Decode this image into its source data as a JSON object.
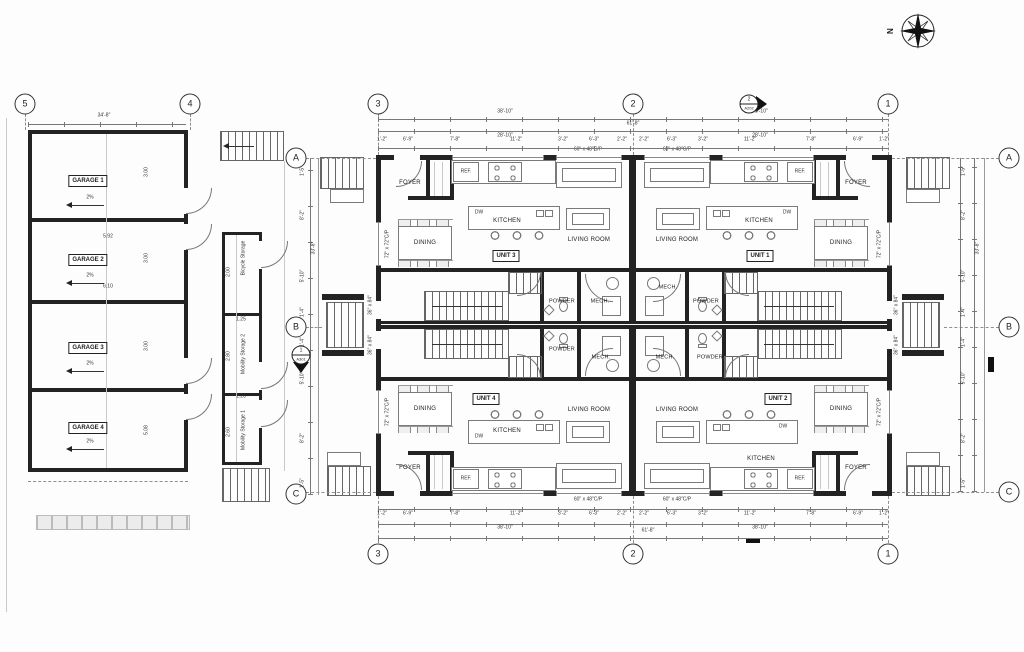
{
  "compass": {
    "north": "N"
  },
  "grid": {
    "cols": [
      "5",
      "4",
      "3",
      "2",
      "1"
    ],
    "rows": [
      "A",
      "B",
      "C"
    ]
  },
  "garage": {
    "top_dim": "34'-8\"",
    "names": [
      "GARAGE 1",
      "GARAGE 2",
      "GARAGE 3",
      "GARAGE 4"
    ],
    "slope": "2%",
    "bay_depth": "3.00",
    "bay4_depth": "5.08",
    "len_a": "5.92",
    "len_b": "6.10"
  },
  "storage": {
    "names": [
      "Bicycle Storage",
      "Mobility Storage 2",
      "Mobility Storage 1"
    ],
    "dims": [
      "2.00",
      "1.25",
      "2.80",
      "1.20",
      "2.60"
    ]
  },
  "units": [
    "UNIT 1",
    "UNIT 2",
    "UNIT 3",
    "UNIT 4"
  ],
  "rooms": {
    "foyer": "FOYER",
    "kitchen": "KITCHEN",
    "dining": "DINING",
    "living": "LIVING ROOM",
    "powder": "POWDER",
    "mech": "MECH.",
    "ref": "REF.",
    "dw": "DW"
  },
  "windows": {
    "living": "60\" x 48\"C/P",
    "side": "72\" x 72\"C/P",
    "door": "36\" x 84\""
  },
  "markers": {
    "section_left": {
      "num": "1",
      "sheet": "A301"
    },
    "section_top": {
      "num": "2",
      "sheet": "A202"
    }
  },
  "dims": {
    "overall": "61'-8\"",
    "half": "38'-10\"",
    "half_inner": "28'-10\"",
    "segs": [
      "1'-2\"",
      "6'-9\"",
      "7'-8\"",
      "11'-2\"",
      "3'-2\"",
      "6'-3\"",
      "2'-2\""
    ],
    "side_segs": [
      "1'-5\"",
      "8'-2\"",
      "5'-10\"",
      "1'-4\""
    ],
    "side_overall": "33'-8\""
  }
}
